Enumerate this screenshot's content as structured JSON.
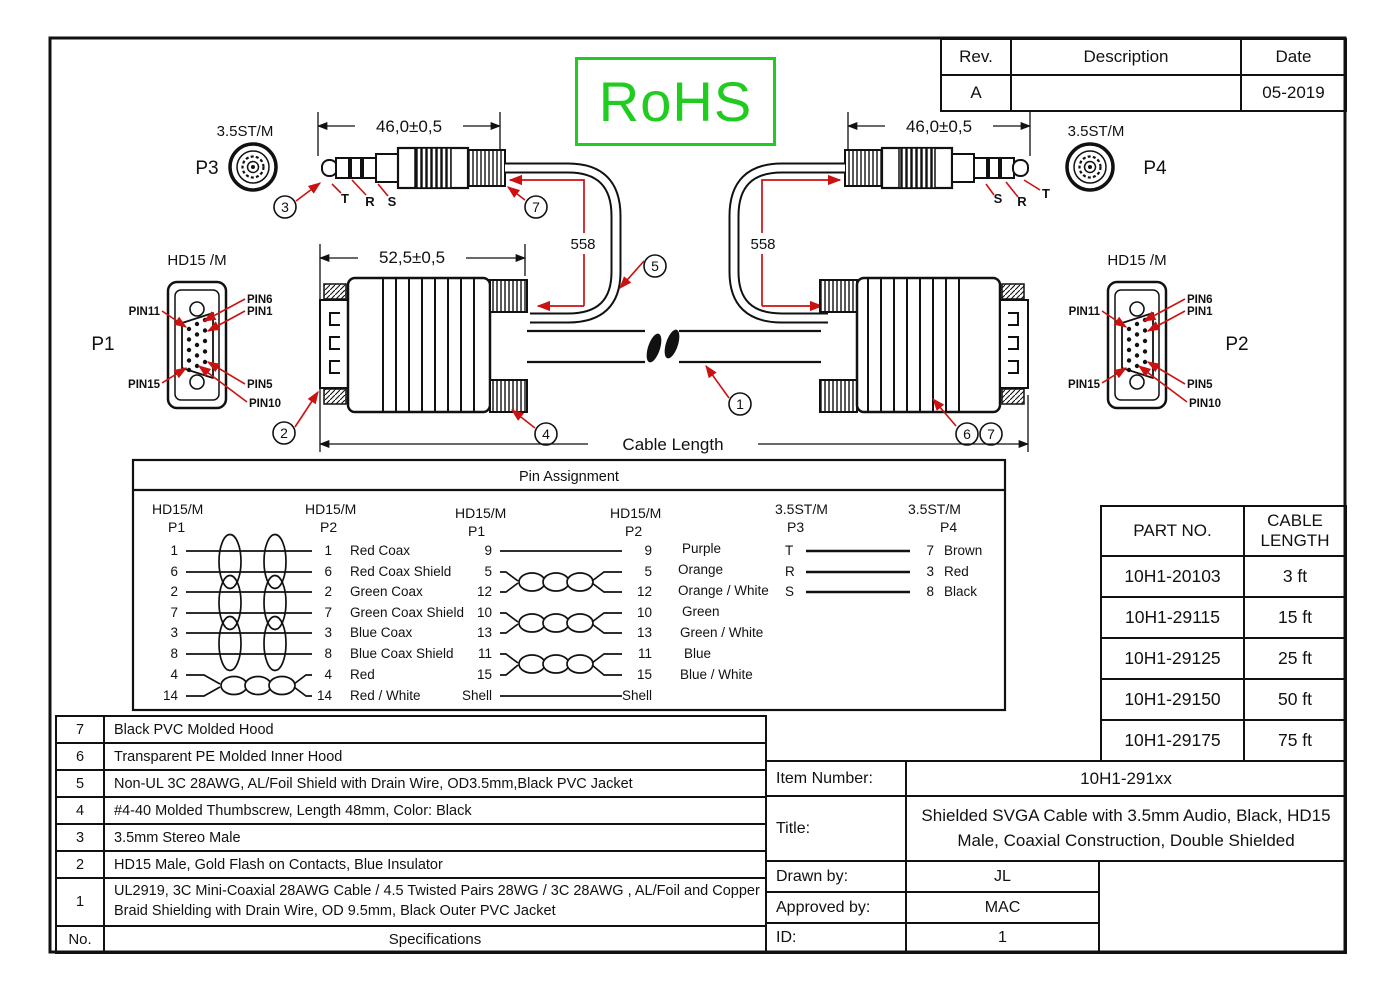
{
  "colors": {
    "red": "#cc1111",
    "green": "#1fcc1f",
    "blue": "#1e72ad",
    "line": "#111111"
  },
  "rev_table": {
    "col_rev": "Rev.",
    "col_desc": "Description",
    "col_date": "Date",
    "row": {
      "rev": "A",
      "desc": "",
      "date": "05-2019"
    }
  },
  "rohs_label": "RoHS",
  "diagram": {
    "dim_left_plug": "46,0±0,5",
    "dim_right_plug": "46,0±0,5",
    "dim_vga": "52,5±0,5",
    "dim_audio_left": "558",
    "dim_audio_right": "558",
    "cable_length_label": "Cable Length",
    "p3_type": "3.5ST/M",
    "p3_name": "P3",
    "p4_type": "3.5ST/M",
    "p4_name": "P4",
    "p1_type": "HD15 /M",
    "p1_name": "P1",
    "p2_type": "HD15 /M",
    "p2_name": "P2",
    "plug_left_pins": {
      "t": "T",
      "r": "R",
      "s": "S"
    },
    "plug_right_pins": {
      "s": "S",
      "r": "R",
      "t": "T"
    },
    "hd15_left_labels": {
      "pin11": "PIN11",
      "pin15": "PIN15",
      "pin6": "PIN6",
      "pin1": "PIN1",
      "pin5": "PIN5",
      "pin10": "PIN10"
    },
    "hd15_right_labels": {
      "pin11": "PIN11",
      "pin15": "PIN15",
      "pin6": "PIN6",
      "pin1": "PIN1",
      "pin5": "PIN5",
      "pin10": "PIN10"
    },
    "callout_1": "1",
    "callout_2": "2",
    "callout_3": "3",
    "callout_4": "4",
    "callout_5": "5",
    "callout_6": "6",
    "callout_7_top": "7",
    "callout_7_bottom": "7"
  },
  "pin_assignment": {
    "title": "Pin Assignment",
    "headers": [
      {
        "l1": "HD15/M",
        "l2": "P1"
      },
      {
        "l1": "HD15/M",
        "l2": "P2"
      },
      {
        "l1": "HD15/M",
        "l2": "P1"
      },
      {
        "l1": "HD15/M",
        "l2": "P2"
      },
      {
        "l1": "3.5ST/M",
        "l2": "P3"
      },
      {
        "l1": "3.5ST/M",
        "l2": "P4"
      }
    ],
    "coax_rows": [
      {
        "p1": "1",
        "p2": "1",
        "label": "Red Coax"
      },
      {
        "p1": "6",
        "p2": "6",
        "label": "Red Coax Shield"
      },
      {
        "p1": "2",
        "p2": "2",
        "label": "Green Coax"
      },
      {
        "p1": "7",
        "p2": "7",
        "label": "Green Coax Shield"
      },
      {
        "p1": "3",
        "p2": "3",
        "label": "Blue Coax"
      },
      {
        "p1": "8",
        "p2": "8",
        "label": "Blue Coax Shield"
      },
      {
        "p1": "4",
        "p2": "4",
        "label": "Red"
      },
      {
        "p1": "14",
        "p2": "14",
        "label": "Red / White"
      }
    ],
    "tp_rows": [
      {
        "p1": "9",
        "p2": "9",
        "label": "Purple"
      },
      {
        "p1": "5",
        "p2": "5",
        "label": "Orange"
      },
      {
        "p1": "12",
        "p2": "12",
        "label": "Orange / White"
      },
      {
        "p1": "10",
        "p2": "10",
        "label": "Green"
      },
      {
        "p1": "13",
        "p2": "13",
        "label": "Green / White"
      },
      {
        "p1": "11",
        "p2": "11",
        "label": "Blue"
      },
      {
        "p1": "15",
        "p2": "15",
        "label": "Blue / White"
      },
      {
        "p1": "Shell",
        "p2": "Shell",
        "label": ""
      }
    ],
    "audio_rows": [
      {
        "p3": "T",
        "p4": "7",
        "color": "Brown"
      },
      {
        "p3": "R",
        "p4": "3",
        "color": "Red"
      },
      {
        "p3": "S",
        "p4": "8",
        "color": "Black"
      }
    ]
  },
  "part_table": {
    "h1": "PART NO.",
    "h2": "CABLE LENGTH",
    "rows": [
      {
        "pn": "10H1-20103",
        "len": "3 ft"
      },
      {
        "pn": "10H1-29115",
        "len": "15 ft"
      },
      {
        "pn": "10H1-29125",
        "len": "25 ft"
      },
      {
        "pn": "10H1-29150",
        "len": "50 ft"
      },
      {
        "pn": "10H1-29175",
        "len": "75 ft"
      }
    ]
  },
  "spec_table": {
    "rows": [
      {
        "no": "7",
        "text": "Black PVC Molded Hood"
      },
      {
        "no": "6",
        "text": "Transparent PE Molded  Inner Hood"
      },
      {
        "no": "5",
        "text": "Non-UL 3C 28AWG, AL/Foil Shield with Drain Wire, OD3.5mm,Black PVC Jacket"
      },
      {
        "no": "4",
        "text": "#4-40 Molded Thumbscrew, Length 48mm, Color: Black"
      },
      {
        "no": "3",
        "text": "3.5mm Stereo Male"
      },
      {
        "no": "2",
        "text": "HD15 Male, Gold Flash on Contacts, Blue Insulator"
      },
      {
        "no": "1",
        "text": "UL2919, 3C Mini-Coaxial 28AWG Cable / 4.5 Twisted Pairs  28WG / 3C 28AWG , AL/Foil and Copper Braid Shielding with Drain Wire, OD 9.5mm, Black Outer PVC Jacket"
      }
    ],
    "footer_no": "No.",
    "footer_label": "Specifications"
  },
  "info_block": {
    "item_label": "Item Number:",
    "item_value": "10H1-291xx",
    "title_label": "Title:",
    "title_value": "Shielded SVGA Cable with 3.5mm Audio, Black, HD15 Male, Coaxial Construction, Double Shielded",
    "drawn_label": "Drawn by:",
    "drawn_value": "JL",
    "approved_label": "Approved by:",
    "approved_value": "MAC",
    "id_label": "ID:",
    "id_value": "1"
  },
  "logo": {
    "phone": "888-212-8295",
    "name": "CableWholesale",
    "tld": ".com"
  }
}
